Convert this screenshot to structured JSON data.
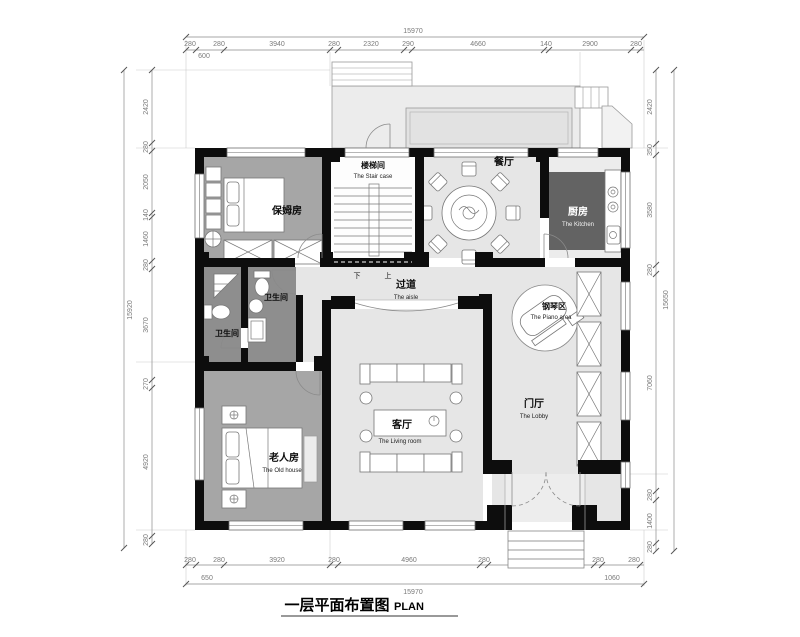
{
  "title": {
    "zh": "一层平面布置图",
    "en": "PLAN"
  },
  "rooms": {
    "stair": {
      "zh": "楼梯间",
      "en": "The Stair case"
    },
    "dining": {
      "zh": "餐厅"
    },
    "kitchen": {
      "zh": "厨房",
      "en": "The Kitchen"
    },
    "nanny": {
      "zh": "保姆房"
    },
    "bath_a": {
      "zh": "卫生间"
    },
    "bath_b": {
      "zh": "卫生间"
    },
    "aisle": {
      "zh": "过道",
      "en": "The aisle"
    },
    "piano": {
      "zh": "钢琴区",
      "en": "The Piano area"
    },
    "lobby": {
      "zh": "门厅",
      "en": "The Lobby"
    },
    "living": {
      "zh": "客厅",
      "en": "The Living room"
    },
    "old_room": {
      "zh": "老人房",
      "en": "The Old house"
    }
  },
  "stair_marks": {
    "down": "下",
    "up": "上"
  },
  "dimensions": {
    "top": {
      "total": "15970",
      "offset": "600",
      "segments": [
        "280",
        "280",
        "3940",
        "280",
        "2320",
        "290",
        "4660",
        "140",
        "2900",
        "280"
      ]
    },
    "bottom": {
      "total": "15970",
      "offset_left": "650",
      "offset_right": "1060",
      "segments": [
        "280",
        "280",
        "3920",
        "280",
        "4960",
        "280",
        "3680",
        "280",
        "280"
      ]
    },
    "left": {
      "total": "15920",
      "segments": [
        "2420",
        "280",
        "2050",
        "140",
        "1460",
        "280",
        "3670",
        "270",
        "4920",
        "280"
      ]
    },
    "right": {
      "total": "15650",
      "segments": [
        "2420",
        "350",
        "3580",
        "280",
        "7060",
        "280",
        "1400",
        "280"
      ]
    }
  },
  "colors": {
    "wall": "#0d0d0d",
    "floor_light": "#e6e6e6",
    "floor_mid": "#a6a6a6",
    "floor_dark": "#8e8e8e",
    "kitchen_block": "#636363",
    "dim": "#7a7a7a",
    "dimline": "#8a8a8a"
  }
}
